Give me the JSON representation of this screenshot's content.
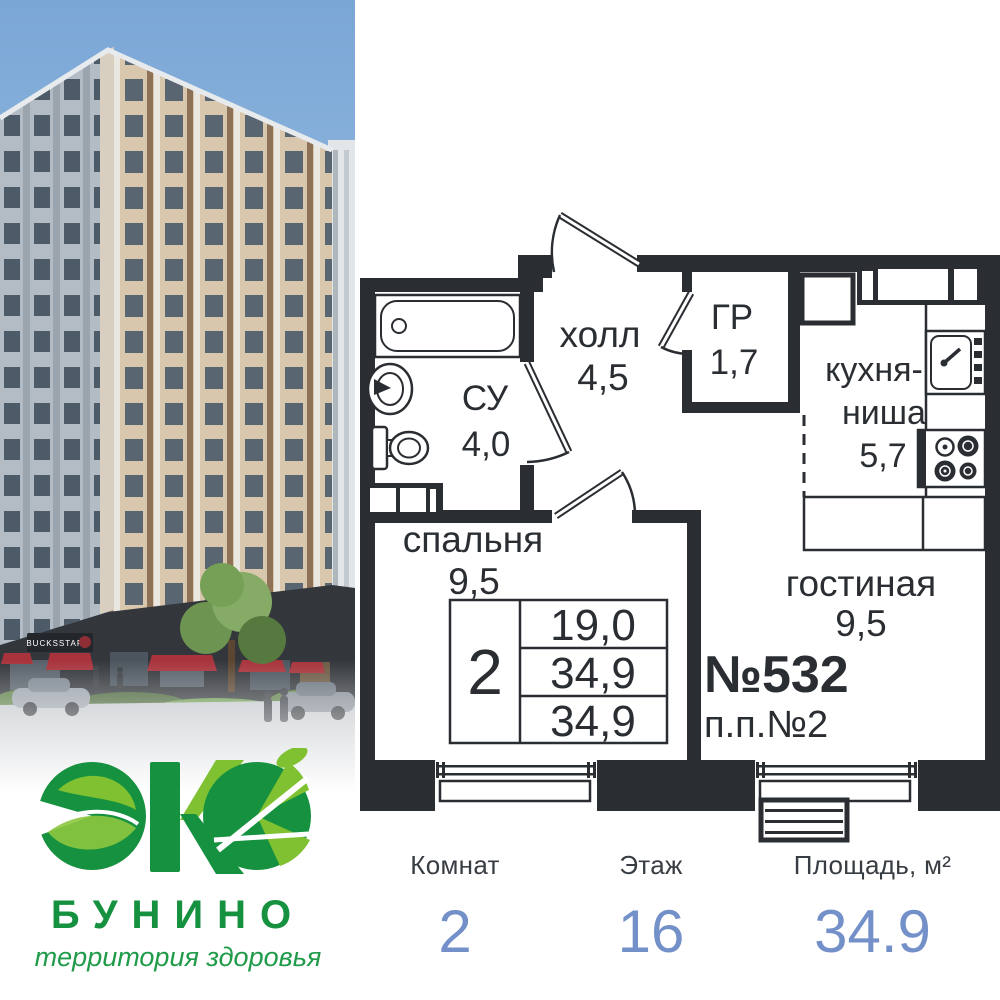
{
  "logo": {
    "brand": "БУНИНО",
    "tagline": "территория здоровья",
    "green_dark": "#15913f",
    "green_light": "#7fc131"
  },
  "photo": {
    "storefront_sign": "BUCKSSTAR",
    "awning_red": "#a8333c"
  },
  "floor_plan": {
    "ink": "#2a2e32",
    "apartment_number": "№532",
    "position_number": "п.п.№2",
    "rooms": {
      "hall": {
        "name": "холл",
        "area": "4,5"
      },
      "wardrobe": {
        "name": "ГР",
        "area": "1,7"
      },
      "kitchen": {
        "line1": "кухня-",
        "line2": "ниша",
        "area": "5,7"
      },
      "bathroom": {
        "name": "СУ",
        "area": "4,0"
      },
      "bedroom": {
        "name": "спальня",
        "area": "9,5"
      },
      "living": {
        "name": "гостиная",
        "area": "9,5"
      }
    },
    "stamp": {
      "rooms": "2",
      "row1": "19,0",
      "row2": "34,9",
      "row3": "34,9"
    }
  },
  "stats": {
    "accent_blue": "#7390c9",
    "columns": [
      {
        "label": "Комнат",
        "value": "2"
      },
      {
        "label": "Этаж",
        "value": "16"
      },
      {
        "label": "Площадь, м²",
        "value": "34.9"
      }
    ]
  }
}
